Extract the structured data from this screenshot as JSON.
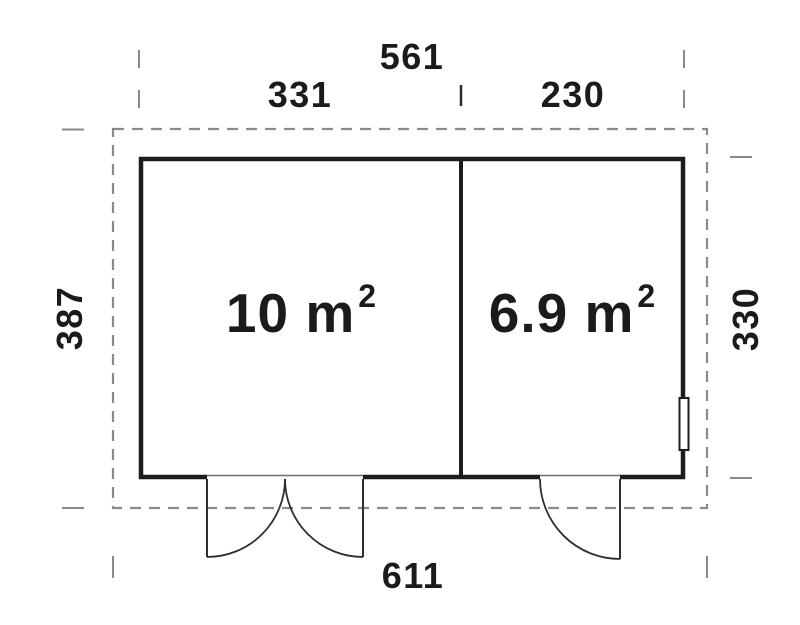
{
  "dimensions": {
    "overall_width": "561",
    "left_section_width": "331",
    "right_section_width": "230",
    "left_height": "387",
    "right_height": "330",
    "bottom_width": "611"
  },
  "rooms": [
    {
      "area_label": "10 m²",
      "area_base": "10 m",
      "area_exponent": "2"
    },
    {
      "area_label": "6.9 m²",
      "area_base": "6.9 m",
      "area_exponent": "2"
    }
  ],
  "colors": {
    "wall": "#1c1c1c",
    "dashed_outline": "#8a8a8a",
    "door_swing": "#2e2e2e",
    "text": "#1b1b1b",
    "background": "#ffffff"
  }
}
